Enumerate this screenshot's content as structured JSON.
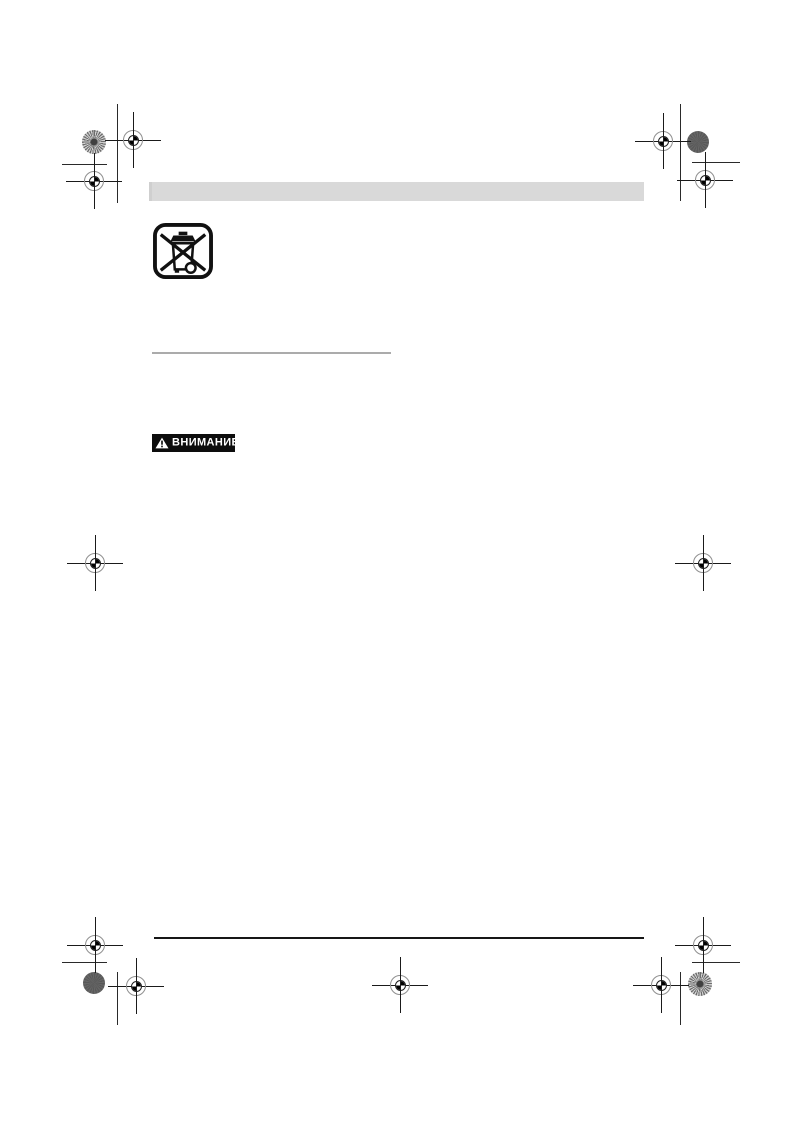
{
  "document": {
    "page_kind": "manual-print-proof-page",
    "warning_badge": {
      "label": "ВНИМАНИЕ",
      "icon": "warning-triangle-icon"
    },
    "symbols": {
      "weee": "crossed-out-wheeled-bin-icon"
    },
    "printer_marks": {
      "registration_crosshairs": 11,
      "ink_density_patches": 4,
      "crop_lines": 8
    },
    "colors": {
      "page_background": "#ffffff",
      "header_bar": "#d9d9d9",
      "divider_rule": "#ababab",
      "footer_rule": "#161616",
      "badge_background": "#0d0d0d",
      "badge_text": "#ffffff",
      "registration_mark": "#1a1a1a",
      "patch_dark": "#5d5d5d",
      "patch_light": "#cfcfcf"
    }
  }
}
